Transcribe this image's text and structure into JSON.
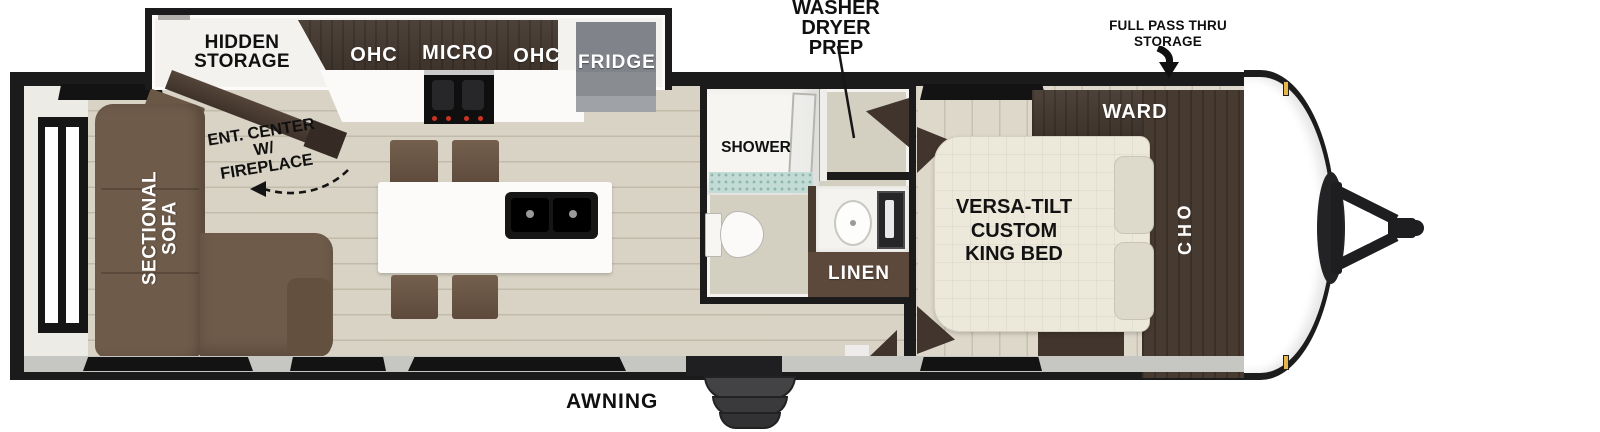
{
  "colors": {
    "wall_black": "#1b1b1b",
    "floor_wood": "#d8d3c5",
    "floor_bedroom": "#ddd8ca",
    "cabinet_dark_wood": "#44382f",
    "sofa_brown": "#6f5b4a",
    "bed_cream": "#ece8da",
    "fridge_gray": "#898c91",
    "shower_tile_teal": "#c2dbd4",
    "clearance_light_amber": "#e8b54a"
  },
  "annotations": {
    "washer_dryer_prep": "WASHER DRYER PREP",
    "full_pass_thru_storage": "FULL PASS THRU STORAGE",
    "awning": "AWNING"
  },
  "living_area": {
    "hidden_storage": "HIDDEN STORAGE",
    "ent_center": "ENT. CENTER W/ FIREPLACE",
    "sectional_sofa": "SECTIONAL SOFA"
  },
  "kitchen": {
    "ohc_left": "OHC",
    "micro": "MICRO",
    "ohc_right": "OHC",
    "fridge": "FRIDGE"
  },
  "bathroom": {
    "shower": "SHOWER",
    "linen": "LINEN"
  },
  "bedroom": {
    "ward": "WARD",
    "ohc": "OHC",
    "bed": "VERSA-TILT CUSTOM KING BED"
  }
}
